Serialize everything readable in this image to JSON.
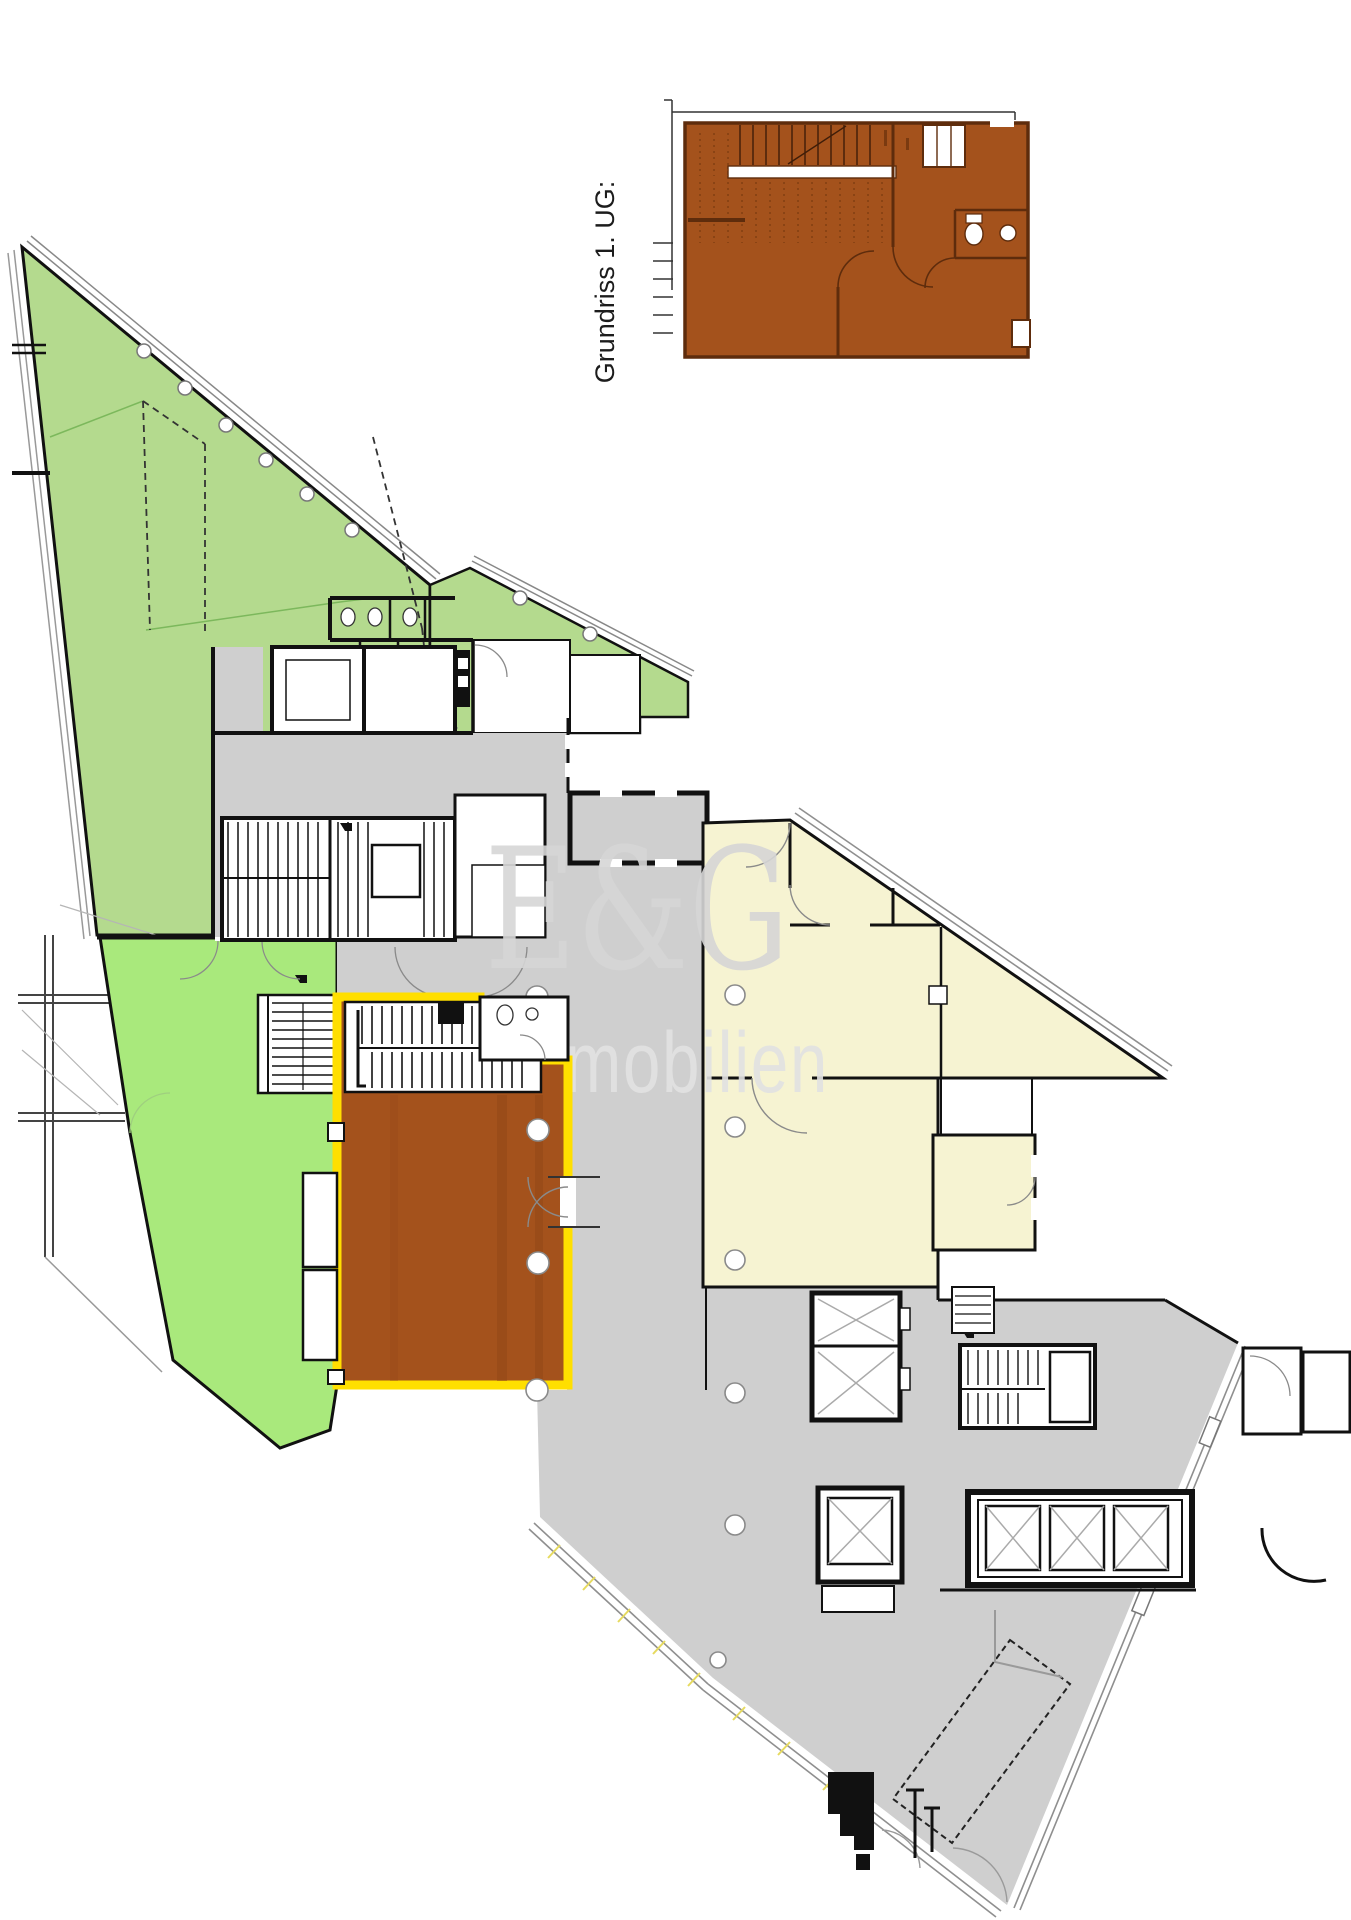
{
  "inset": {
    "label": "Grundriss 1. UG:"
  },
  "watermark": {
    "brand": "E&G",
    "subtitle": "Immobilien"
  },
  "palette": {
    "highlight_unit": "#a4521c",
    "unit_border": "#ffdf00",
    "area_green_upper": "#b4da8e",
    "area_green_lower": "#a9e97c",
    "area_gray": "#cfcfcf",
    "area_cream": "#f6f3d2",
    "inset_fill": "#a4521c",
    "inset_wall": "#5e2c0c",
    "walls": "#111111",
    "watermark_brand": "#d6d6d6",
    "watermark_subtitle": "#e2e2e2"
  }
}
